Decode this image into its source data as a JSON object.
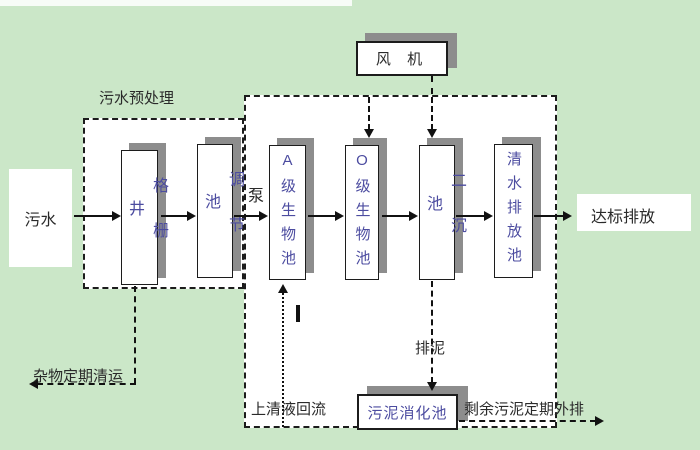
{
  "colors": {
    "page_bg": "#cbe7c8",
    "panel_bg": "#ffffff",
    "shadow": "#8d8d8d",
    "line": "#111111",
    "tank_text": "#4c4ca0",
    "label_text": "#2a2a2a"
  },
  "regions": {
    "pretreatment_title": "污水预处理"
  },
  "nodes": {
    "influent": "污水",
    "grid_well": "格栅井",
    "regulating_tank": "调节池",
    "a_bio_tank": "A级生物池",
    "o_bio_tank": "O级生物池",
    "secondary_settling_tank": "二沉池",
    "clear_water_tank": "清水排放池",
    "fan": "风 机",
    "sludge_digestion_tank": "污泥消化池",
    "effluent": "达标排放"
  },
  "flow_labels": {
    "pump": "泵",
    "debris_removal": "杂物定期清运",
    "supernatant_return": "上清液回流",
    "sludge_discharge": "排泥",
    "excess_sludge_out": "剩余污泥定期外排"
  }
}
